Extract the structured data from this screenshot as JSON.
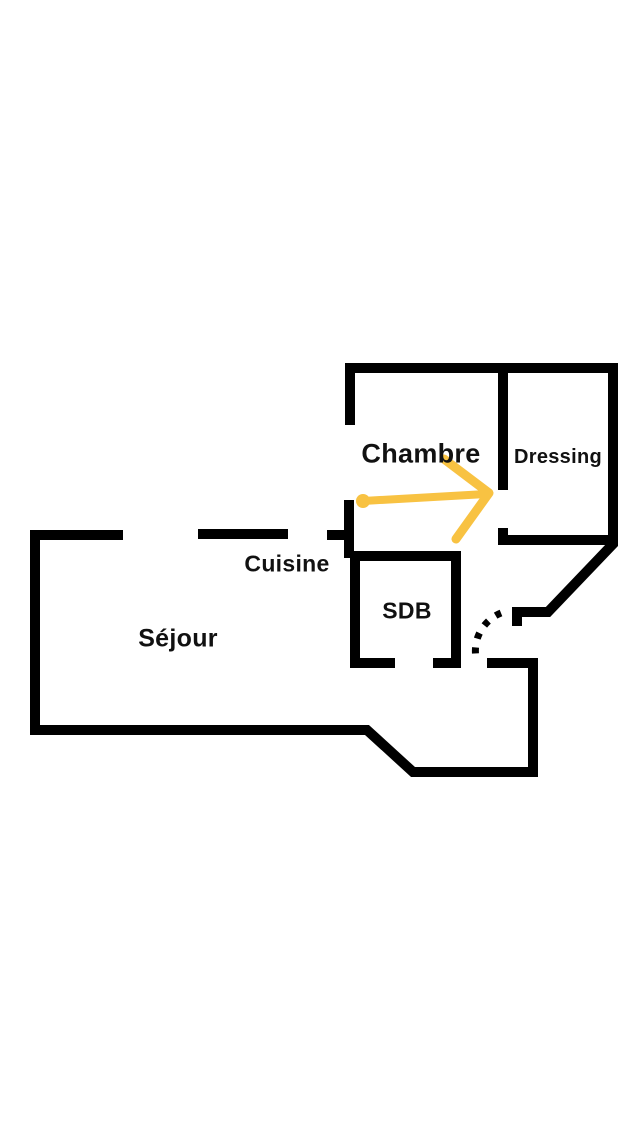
{
  "colors": {
    "background": "#ffffff",
    "wall": "#000000",
    "arrow": "#f8c242",
    "label": "#111111"
  },
  "floorplan": {
    "rooms": [
      {
        "name": "Chambre"
      },
      {
        "name": "Dressing"
      },
      {
        "name": "Cuisine"
      },
      {
        "name": "SDB"
      },
      {
        "name": "Séjour"
      }
    ],
    "annotations": {
      "door_arc": "dashed-door-swing",
      "arrow": "yellow-direction-arrow"
    }
  }
}
